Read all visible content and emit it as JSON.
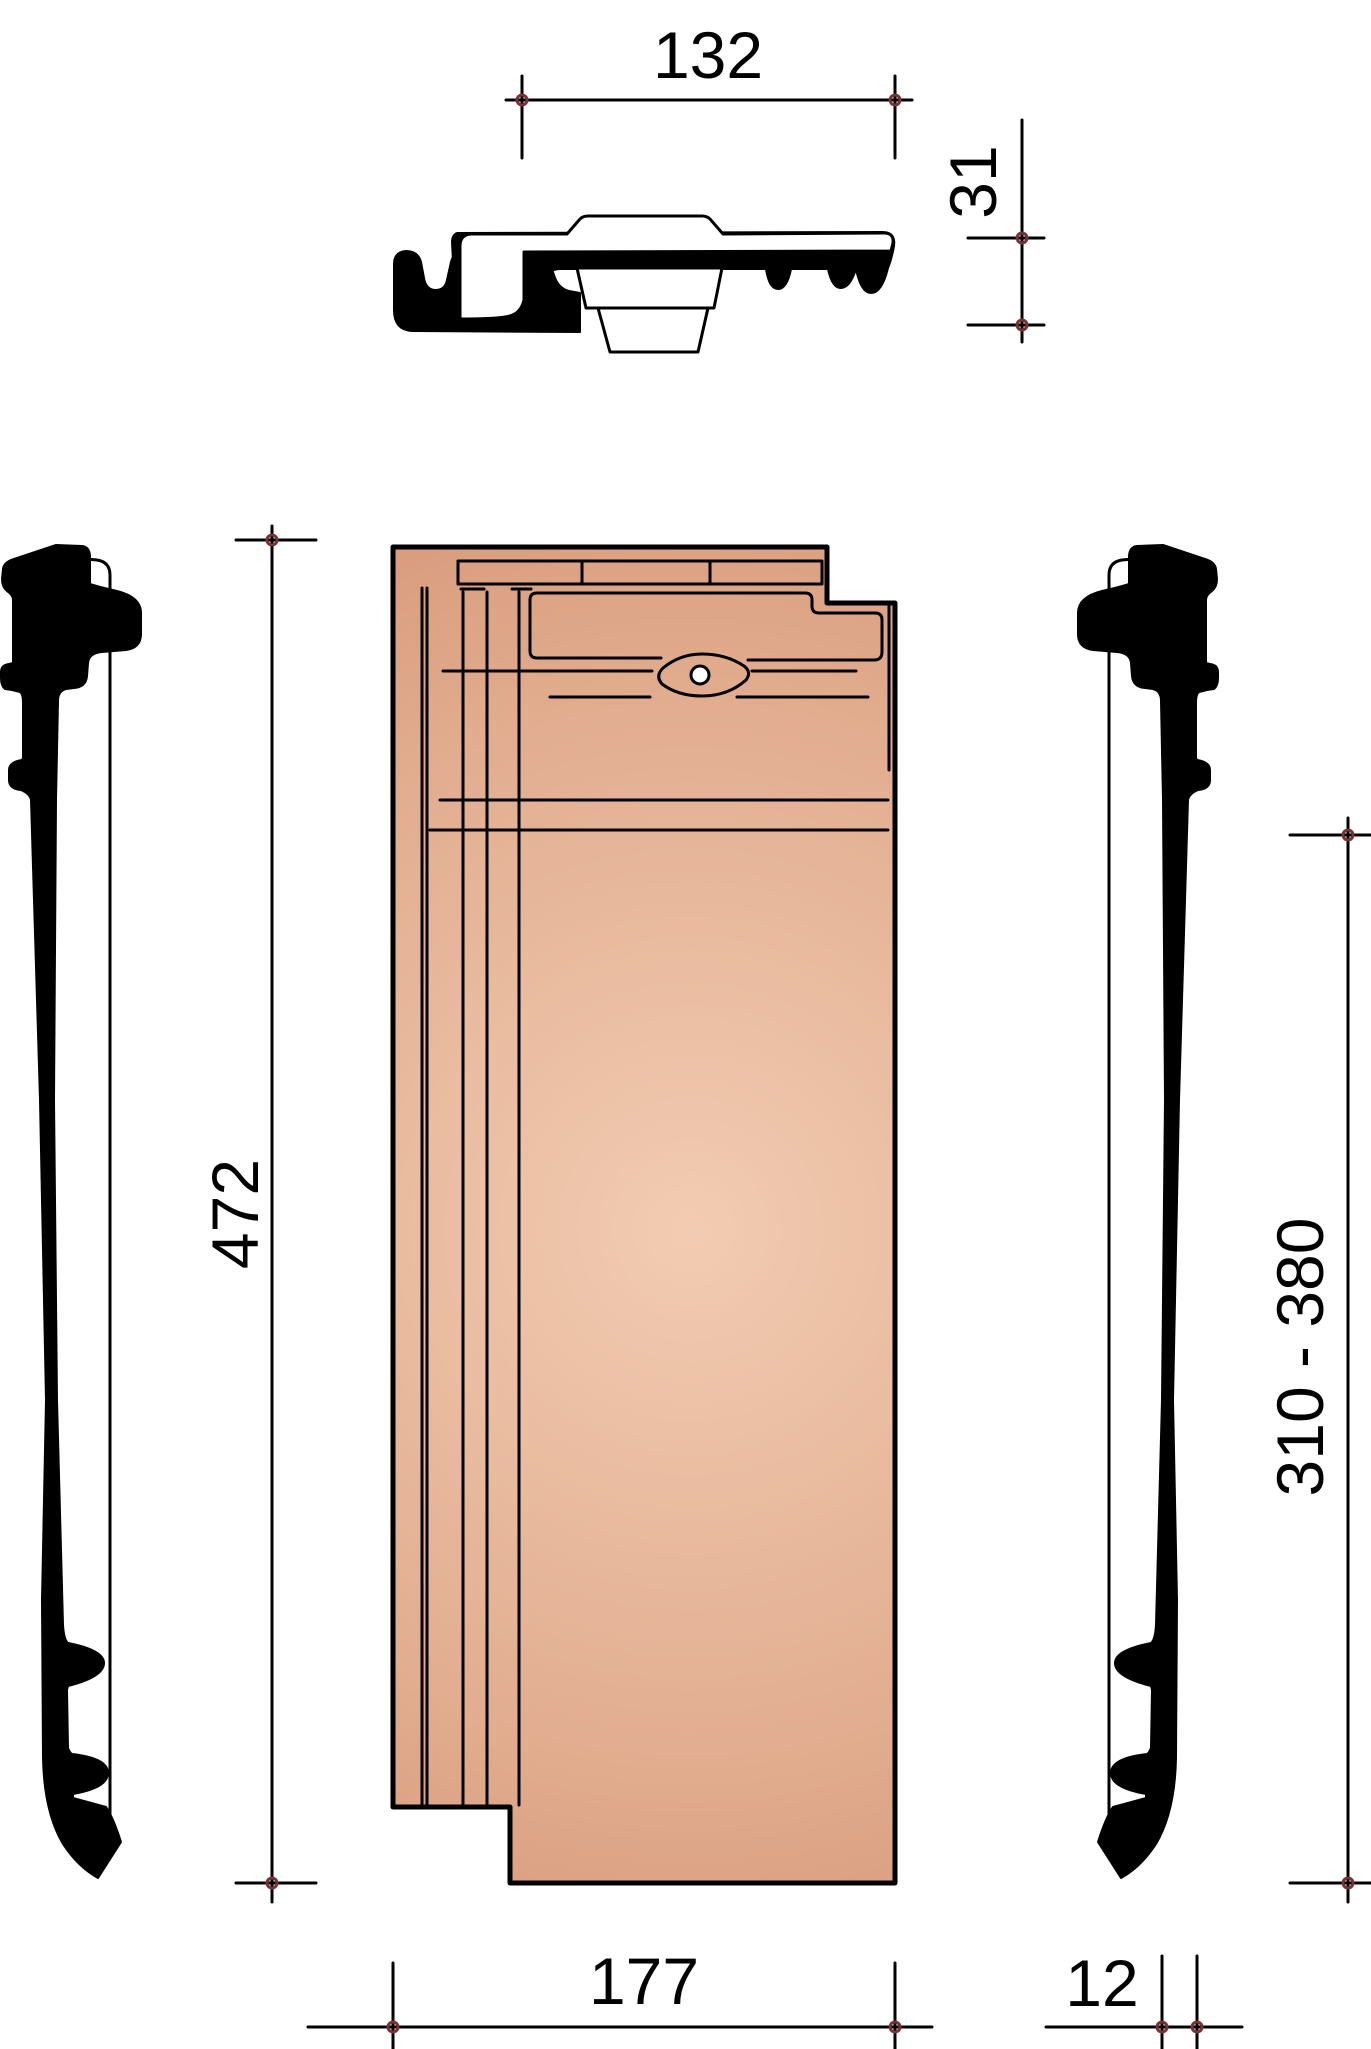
{
  "dimensions": {
    "section_width": "132",
    "section_height": "31",
    "tile_length": "472",
    "gauge_range": "310 - 380",
    "cover_width": "177",
    "edge_thickness": "12"
  },
  "colors": {
    "line": "#000000",
    "silhouette": "#000000",
    "tick_marker": "#7a3332",
    "tile_light": "#f2ccb2",
    "tile_mid": "#e2ad90",
    "tile_dark": "#d08e6c",
    "background": "#ffffff"
  }
}
